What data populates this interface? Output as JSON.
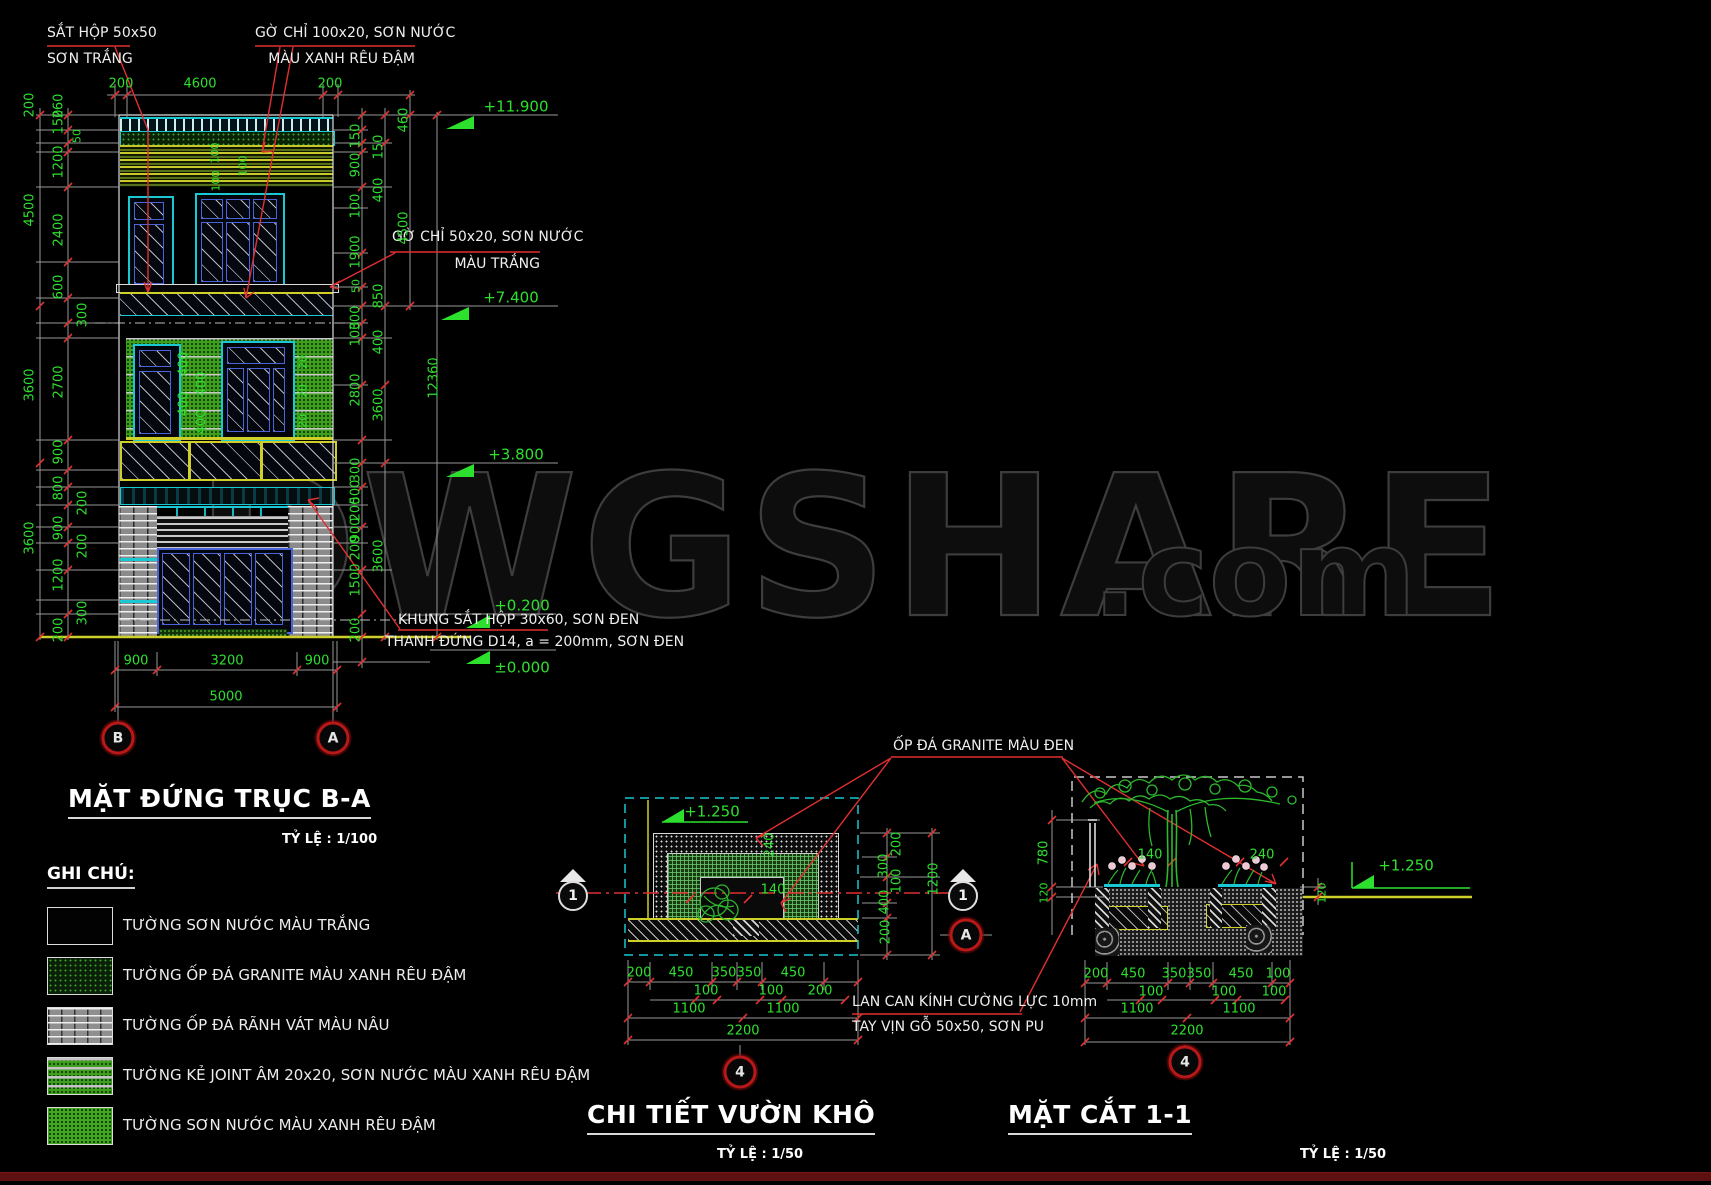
{
  "watermark": {
    "main": "DWGSHARE",
    "suffix": ".com"
  },
  "elev": {
    "title": "MẶT ĐỨNG TRỤC B-A",
    "scale": "TỶ LỆ : 1/100",
    "top_dims": [
      "200",
      "4600",
      "200"
    ],
    "levels": [
      "+11.900",
      "+7.400",
      "+3.800",
      "+0.200",
      "±0.000"
    ],
    "left_outer": [
      "200",
      "4500",
      "3600",
      "3600"
    ],
    "left_inner": [
      "260",
      "150",
      "50",
      "1200",
      "2400",
      "600",
      "300",
      "2700",
      "900",
      "800",
      "200",
      "900",
      "200",
      "1200",
      "300",
      "200"
    ],
    "right_a": [
      "150",
      "900",
      "100",
      "1900",
      "50",
      "300",
      "100",
      "2800",
      "300",
      "500",
      "200",
      "900",
      "200",
      "1500",
      "200"
    ],
    "right_b": [
      "150",
      "400",
      "850",
      "400",
      "3600",
      "3600"
    ],
    "right_c": [
      "460",
      "4500"
    ],
    "right_total": "12360",
    "stripe_dims": [
      "100",
      "100",
      "100"
    ],
    "joint_dims": [
      "400",
      "400",
      "400",
      "400"
    ],
    "joint_small": [
      "20",
      "20",
      "20"
    ],
    "bottom_row1": [
      "900",
      "3200",
      "900"
    ],
    "bottom_total": "5000",
    "axis_left": "B",
    "axis_right": "A",
    "ann": {
      "sat1": "SẮT HỘP 50x50",
      "sat2": "SƠN TRẮNG",
      "gochi100_1": "GỜ CHỈ 100x20, SƠN NƯỚC",
      "gochi100_2": "MÀU XANH RÊU ĐẬM",
      "gochi50_1": "GỜ CHỈ 50x20, SƠN NƯỚC",
      "gochi50_2": "MÀU TRẮNG",
      "khung": "KHUNG SẮT HỘP 30x60, SƠN ĐEN",
      "thanh": "THANH ĐỨNG D14, a = 200mm, SƠN ĐEN"
    }
  },
  "legend": {
    "title": "GHI CHÚ:",
    "items": [
      {
        "label": "TƯỜNG SƠN NƯỚC MÀU TRẮNG"
      },
      {
        "label": "TƯỜNG ỐP ĐÁ GRANITE MÀU XANH RÊU ĐẬM"
      },
      {
        "label": "TƯỜNG ỐP ĐÁ RÃNH VÁT MÀU NÂU"
      },
      {
        "label": "TƯỜNG KẺ JOINT ÂM 20x20, SƠN NƯỚC MÀU XANH RÊU ĐẬM"
      },
      {
        "label": "TƯỜNG SƠN NƯỚC MÀU XANH RÊU ĐẬM"
      }
    ]
  },
  "garden": {
    "title": "CHI TIẾT VƯỜN KHÔ",
    "scale": "TỶ LỆ : 1/50",
    "level": "+1.250",
    "marker": "1",
    "axis_a": "A",
    "axis_4": "4",
    "right_dims": [
      "200",
      "300",
      "100",
      "400",
      "200"
    ],
    "right_total": "1200",
    "inner": [
      "240",
      "140"
    ],
    "b1": [
      "200",
      "450",
      "350",
      "350",
      "450"
    ],
    "b2": [
      "100",
      "100",
      "200"
    ],
    "b3": [
      "1100",
      "1100"
    ],
    "btotal": "2200"
  },
  "section": {
    "title": "MẶT CẮT 1-1",
    "scale": "TỶ LỆ : 1/50",
    "level": "+1.250",
    "axis_4": "4",
    "left_dims": [
      "780",
      "120"
    ],
    "right_dim": "120",
    "inner": [
      "140",
      "240"
    ],
    "b1": [
      "200",
      "450",
      "350",
      "350",
      "450",
      "100"
    ],
    "b2": [
      "100",
      "100",
      "100"
    ],
    "b3": [
      "1100",
      "1100"
    ],
    "btotal": "2200"
  },
  "shared": {
    "granite": "ỐP ĐÁ GRANITE MÀU ĐEN",
    "lancan1": "LAN CAN KÍNH CƯỜNG LỰC 10mm",
    "lancan2": "TAY VỊN GỖ 50x50, SƠN PU"
  },
  "colors": {
    "dim_green": "#2ee02e",
    "cad_red": "#e03030",
    "cyan": "#19c8d2",
    "yellow": "#cfcf2a",
    "blue_frame": "#4b63d8",
    "wall_green": "#3f9e1c"
  }
}
